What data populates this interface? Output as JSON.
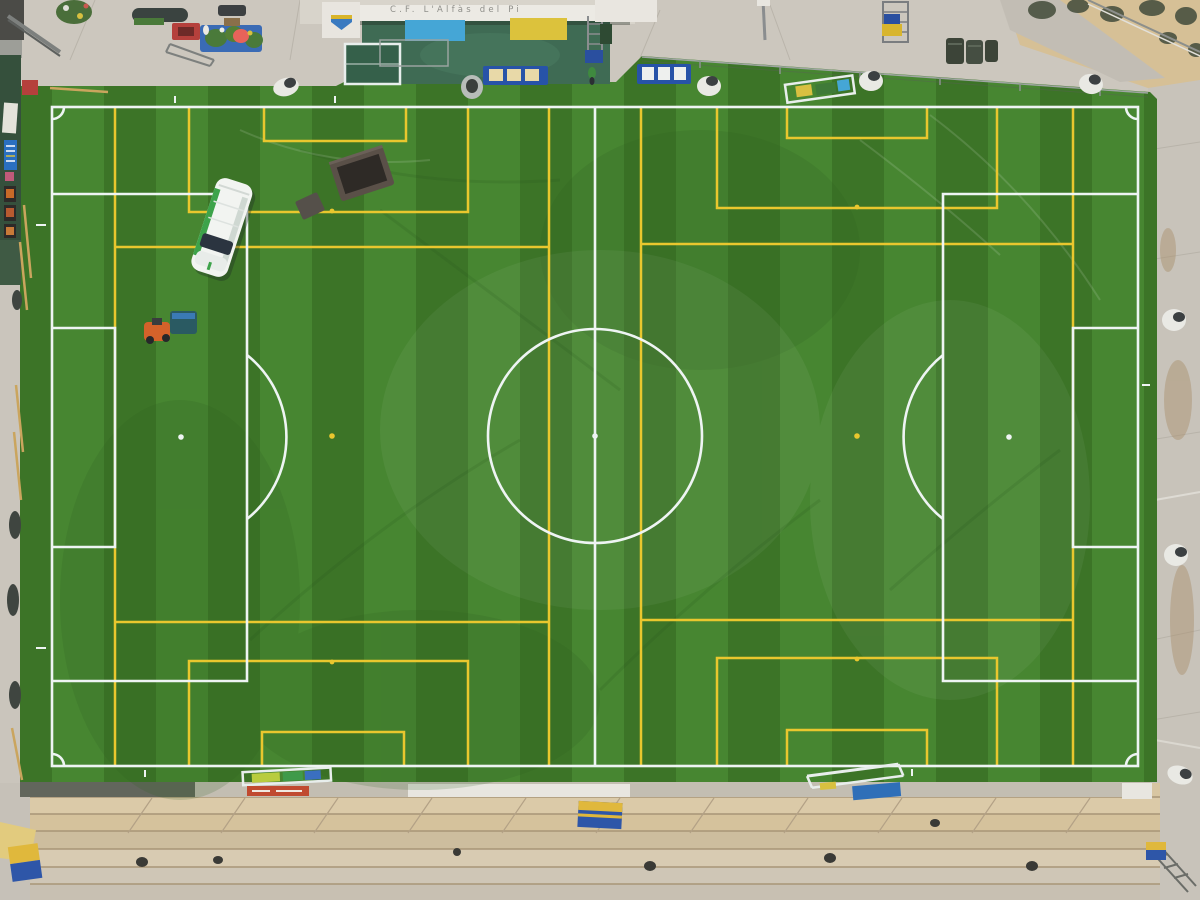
{
  "building": {
    "sign_text": "C.F. L'Alfàs del Pi"
  },
  "colors": {
    "turf-dark": "#3c7427",
    "turf-light": "#478631",
    "line-white": "#eef4f3",
    "line-yellow": "#e9c72e",
    "pavement": "#cac5bc",
    "mini-pitch": "#3f6b54",
    "panel-blue": "#45a6d6",
    "panel-yellow": "#dcc23c",
    "bench-blue": "#2753a8",
    "wall-green": "#35503c",
    "steps-tan": "#d8c6a2",
    "rock-sand": "#d6c096",
    "van-white": "#f2f4f1",
    "van-green": "#3da34a",
    "mower-orange": "#d4622a",
    "hopper-teal": "#2a5a62",
    "banner-red": "#c04a30"
  },
  "objects": {
    "van": "white service van with green stripe",
    "mower": "orange turf sweeper with teal hopper",
    "dumpster": "open dark container",
    "goals_stored": "portable goals lying beside touchlines",
    "floodlight_count": "7",
    "benches": "2 substitute benches",
    "terraces": "concrete terrace steps"
  }
}
